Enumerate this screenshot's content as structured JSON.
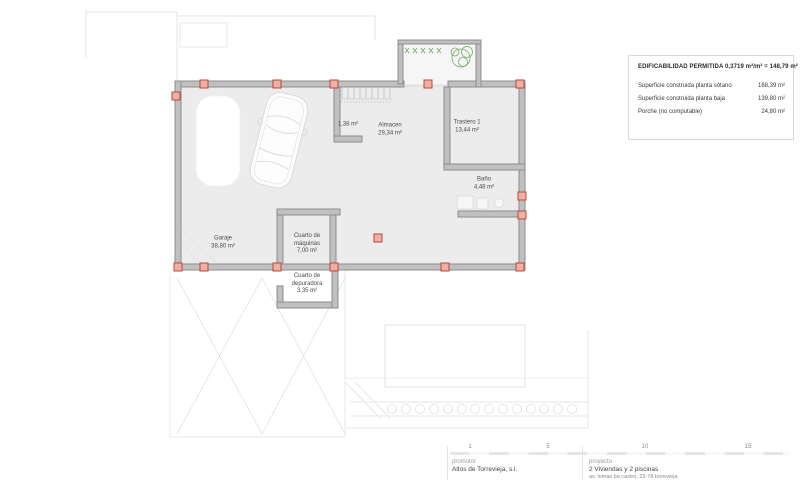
{
  "plan": {
    "rooms": [
      {
        "id": "garaje",
        "name": "Garaje",
        "area": "38,80 m²"
      },
      {
        "id": "closet",
        "name": "",
        "area": "1,38 m²"
      },
      {
        "id": "almacen",
        "name": "Almacen",
        "area": "29,34 m²"
      },
      {
        "id": "trastero",
        "name": "Trastero 1",
        "area": "13,44 m²"
      },
      {
        "id": "bano",
        "name": "Baño",
        "area": "4,48 m²"
      },
      {
        "id": "maquinas",
        "name": "Cuarto de máquinas",
        "area": "7,00 m²"
      },
      {
        "id": "depuradora",
        "name": "Cuarto de depuradora",
        "area": "3,35 m²"
      }
    ]
  },
  "legend": {
    "title": "EDIFICABILIDAD PERMITIDA 0,3719 m²/m² = 148,79 m²",
    "rows": [
      {
        "label": "Superficie construida planta sótano",
        "value": "168,39 m²"
      },
      {
        "label": "Superficie construida planta baja",
        "value": "139,80 m²"
      },
      {
        "label": "Porche (no computable)",
        "value": "24,80 m²"
      }
    ]
  },
  "titleblock": {
    "scale_labels": [
      "1",
      "5",
      "10",
      "15"
    ],
    "promotor_label": "promotor",
    "promotor_value": "Altos de Torrevieja, s.l.",
    "proyecto_label": "proyecto",
    "proyecto_value": "2 Viviendas y 2 piscinas",
    "proyecto_address": "av. lomas ba castro, 23-78 torrevieja"
  },
  "colors": {
    "wall_fill": "#c0c0c0",
    "wall_stroke": "#8d8d8d",
    "floor": "#ececec",
    "column_fill": "#eeb0a4",
    "column_stroke": "#b8493c",
    "plant_green": "#5f9e4a",
    "faint_line": "#dedede"
  }
}
